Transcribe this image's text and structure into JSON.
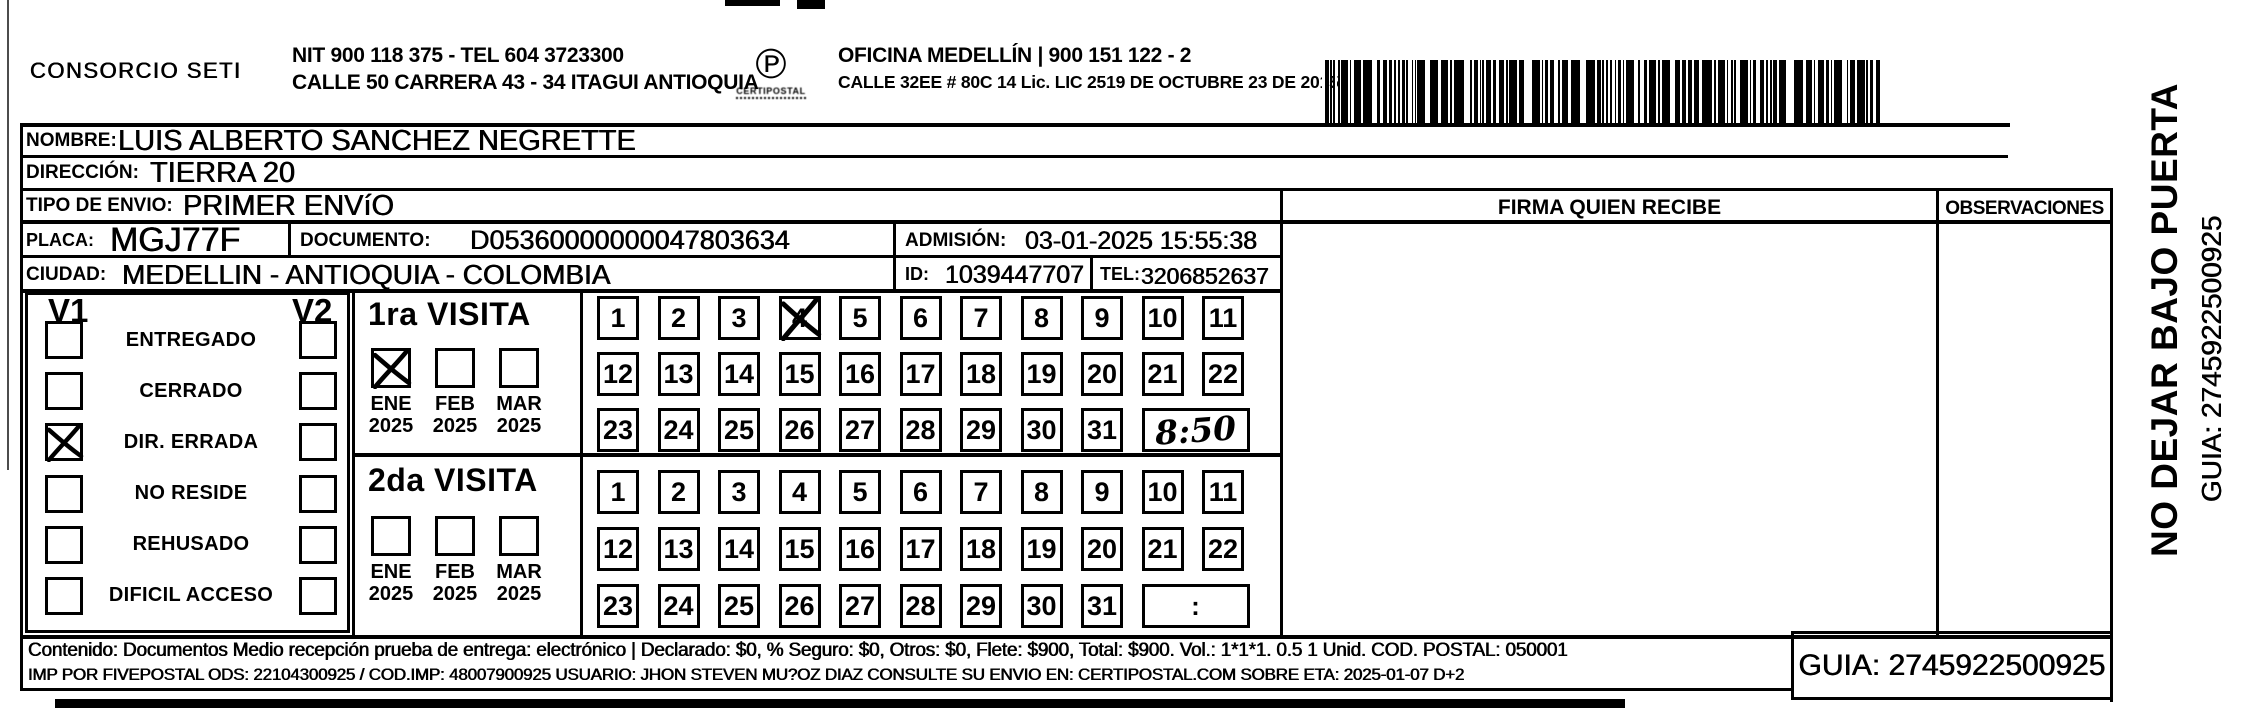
{
  "colors": {
    "ink": "#000000",
    "paper": "#ffffff"
  },
  "header": {
    "company": "CONSORCIO SETI",
    "nit_line": "NIT 900 118 375 - TEL 604 3723300",
    "hq_address": "CALLE 50 CARRERA 43 - 34 ITAGUI ANTIOQUIA",
    "logo_glyph": "℗",
    "logo_caption": "CERTIPOSTAL",
    "office_line": "OFICINA MEDELLÍN | 900 151 122 - 2",
    "office_address": "CALLE 32EE # 80C 14 Lic. LIC 2519 DE OCTUBRE 23 DE 2015"
  },
  "shipment": {
    "nombre_label": "NOMBRE:",
    "nombre": "LUIS ALBERTO SANCHEZ NEGRETTE",
    "direccion_label": "DIRECCIÓN:",
    "direccion": "TIERRA 20",
    "tipo_label": "TIPO DE ENVIO:",
    "tipo": "PRIMER ENVíO",
    "placa_label": "PLACA:",
    "placa": "MGJ77F",
    "documento_label": "DOCUMENTO:",
    "documento": "D05360000000047803634",
    "admision_label": "ADMISIÓN:",
    "admision": "03-01-2025 15:55:38",
    "ciudad_label": "CIUDAD:",
    "ciudad": "MEDELLIN - ANTIOQUIA - COLOMBIA",
    "id_label": "ID:",
    "id": "1039447707",
    "tel_label": "TEL:",
    "tel": "3206852637"
  },
  "signature_area": {
    "firma_header": "FIRMA QUIEN RECIBE",
    "observaciones_header": "OBSERVACIONES"
  },
  "status_panel": {
    "v1_label": "V1",
    "v2_label": "V2",
    "options": [
      {
        "label": "ENTREGADO",
        "v1": false,
        "v2": false
      },
      {
        "label": "CERRADO",
        "v1": false,
        "v2": false
      },
      {
        "label": "DIR. ERRADA",
        "v1": true,
        "v2": false
      },
      {
        "label": "NO RESIDE",
        "v1": false,
        "v2": false
      },
      {
        "label": "REHUSADO",
        "v1": false,
        "v2": false
      },
      {
        "label": "DIFICIL ACCESO",
        "v1": false,
        "v2": false
      }
    ]
  },
  "visits": [
    {
      "title": "1ra VISITA",
      "months": [
        {
          "month": "ENE",
          "year": "2025",
          "checked": true
        },
        {
          "month": "FEB",
          "year": "2025",
          "checked": false
        },
        {
          "month": "MAR",
          "year": "2025",
          "checked": false
        }
      ],
      "day_rows": [
        [
          1,
          2,
          3,
          4,
          5,
          6,
          7,
          8,
          9,
          10,
          11
        ],
        [
          12,
          13,
          14,
          15,
          16,
          17,
          18,
          19,
          20,
          21,
          22
        ],
        [
          23,
          24,
          25,
          26,
          27,
          28,
          29,
          30,
          31
        ]
      ],
      "marked_days": [
        4
      ],
      "time": "8:50",
      "time_handwritten": true
    },
    {
      "title": "2da VISITA",
      "months": [
        {
          "month": "ENE",
          "year": "2025",
          "checked": false
        },
        {
          "month": "FEB",
          "year": "2025",
          "checked": false
        },
        {
          "month": "MAR",
          "year": "2025",
          "checked": false
        }
      ],
      "day_rows": [
        [
          1,
          2,
          3,
          4,
          5,
          6,
          7,
          8,
          9,
          10,
          11
        ],
        [
          12,
          13,
          14,
          15,
          16,
          17,
          18,
          19,
          20,
          21,
          22
        ],
        [
          23,
          24,
          25,
          26,
          27,
          28,
          29,
          30,
          31
        ]
      ],
      "marked_days": [],
      "time": ":",
      "time_handwritten": false
    }
  ],
  "side_panel": {
    "warning": "NO DEJAR BAJO PUERTA",
    "guia": "GUIA: 2745922500925"
  },
  "footer": {
    "line1": "Contenido: Documentos Medio recepción prueba de entrega: electrónico | Declarado: $0, % Seguro: $0, Otros: $0, Flete: $900, Total: $900. Vol.: 1*1*1. 0.5 1 Unid. COD. POSTAL: 050001",
    "line2": "IMP POR FIVEPOSTAL ODS: 22104300925 / COD.IMP: 48007900925 USUARIO: JHON STEVEN MU?OZ DIAZ CONSULTE SU ENVIO EN: CERTIPOSTAL.COM SOBRE ETA: 2025-01-07 D+2",
    "guia": "GUIA: 2745922500925"
  }
}
